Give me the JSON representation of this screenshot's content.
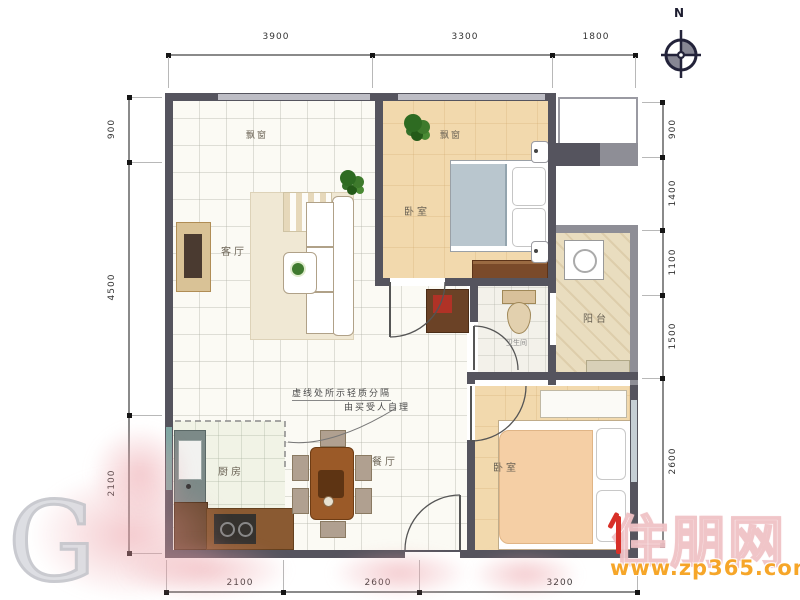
{
  "compass": {
    "label": "N"
  },
  "dimensions": {
    "top": [
      "3900",
      "3300",
      "1800"
    ],
    "left": [
      "900",
      "4500",
      "2100"
    ],
    "right": [
      "900",
      "1400",
      "1100",
      "1500",
      "2600"
    ],
    "bottom": [
      "2100",
      "2600",
      "3200"
    ]
  },
  "rooms": {
    "living": "客厅",
    "bedroom_master": "卧室",
    "bedroom_second": "卧室",
    "balcony": "阳台",
    "bathroom": "卫生间",
    "kitchen": "厨房",
    "dining": "餐厅",
    "bay_window_left": "飘窗",
    "bay_window_right": "飘窗"
  },
  "annotation": {
    "line1": "虚线处所示轻质分隔",
    "line2": "由买受人自理"
  },
  "watermark": {
    "brand": "住朋网",
    "url": "www.zp365.com",
    "corner_letter": "G"
  },
  "colors": {
    "wall": "#55545e",
    "bedroom_floor": "#f2d9ad",
    "balcony_floor": "#e9ddbf",
    "accent_red": "#d83028",
    "brand_orange": "#f6a21e"
  }
}
